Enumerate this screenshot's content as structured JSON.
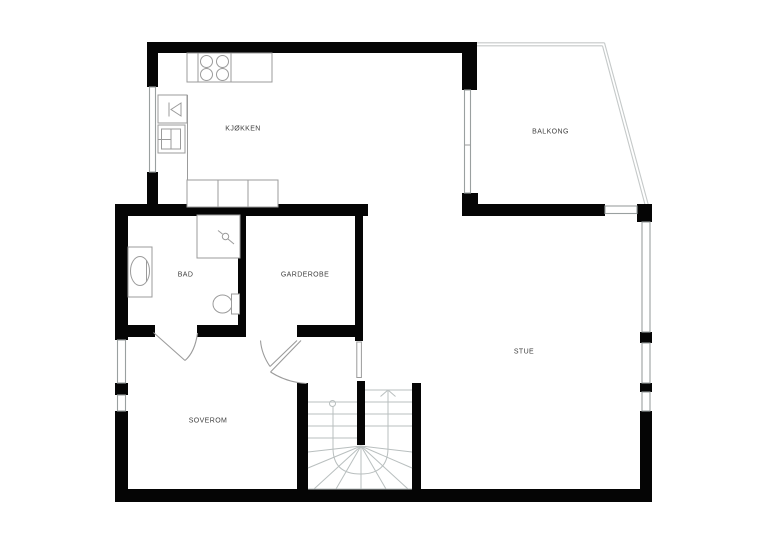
{
  "colors": {
    "background": "#ffffff",
    "wall": "#050505",
    "window_line": "#9aa0a0",
    "fixture_line": "#9b9b9b",
    "stair_line": "#b9bfbf",
    "railing_line": "#c5c9c9",
    "label_text": "#3e3e3e"
  },
  "rooms": [
    {
      "id": "kjokken",
      "label": "KJØKKEN"
    },
    {
      "id": "balkong",
      "label": "BALKONG"
    },
    {
      "id": "bad",
      "label": "BAD"
    },
    {
      "id": "garderobe",
      "label": "GARDEROBE"
    },
    {
      "id": "stue",
      "label": "STUE"
    },
    {
      "id": "soverom",
      "label": "SOVEROM"
    }
  ],
  "stairs": {
    "type": "u-shaped-winder",
    "direction_arrow": "up"
  },
  "fixtures": [
    "stove-burners",
    "kitchen-sink",
    "oven",
    "kitchen-cabinets",
    "shower",
    "washbasin",
    "toilet"
  ]
}
